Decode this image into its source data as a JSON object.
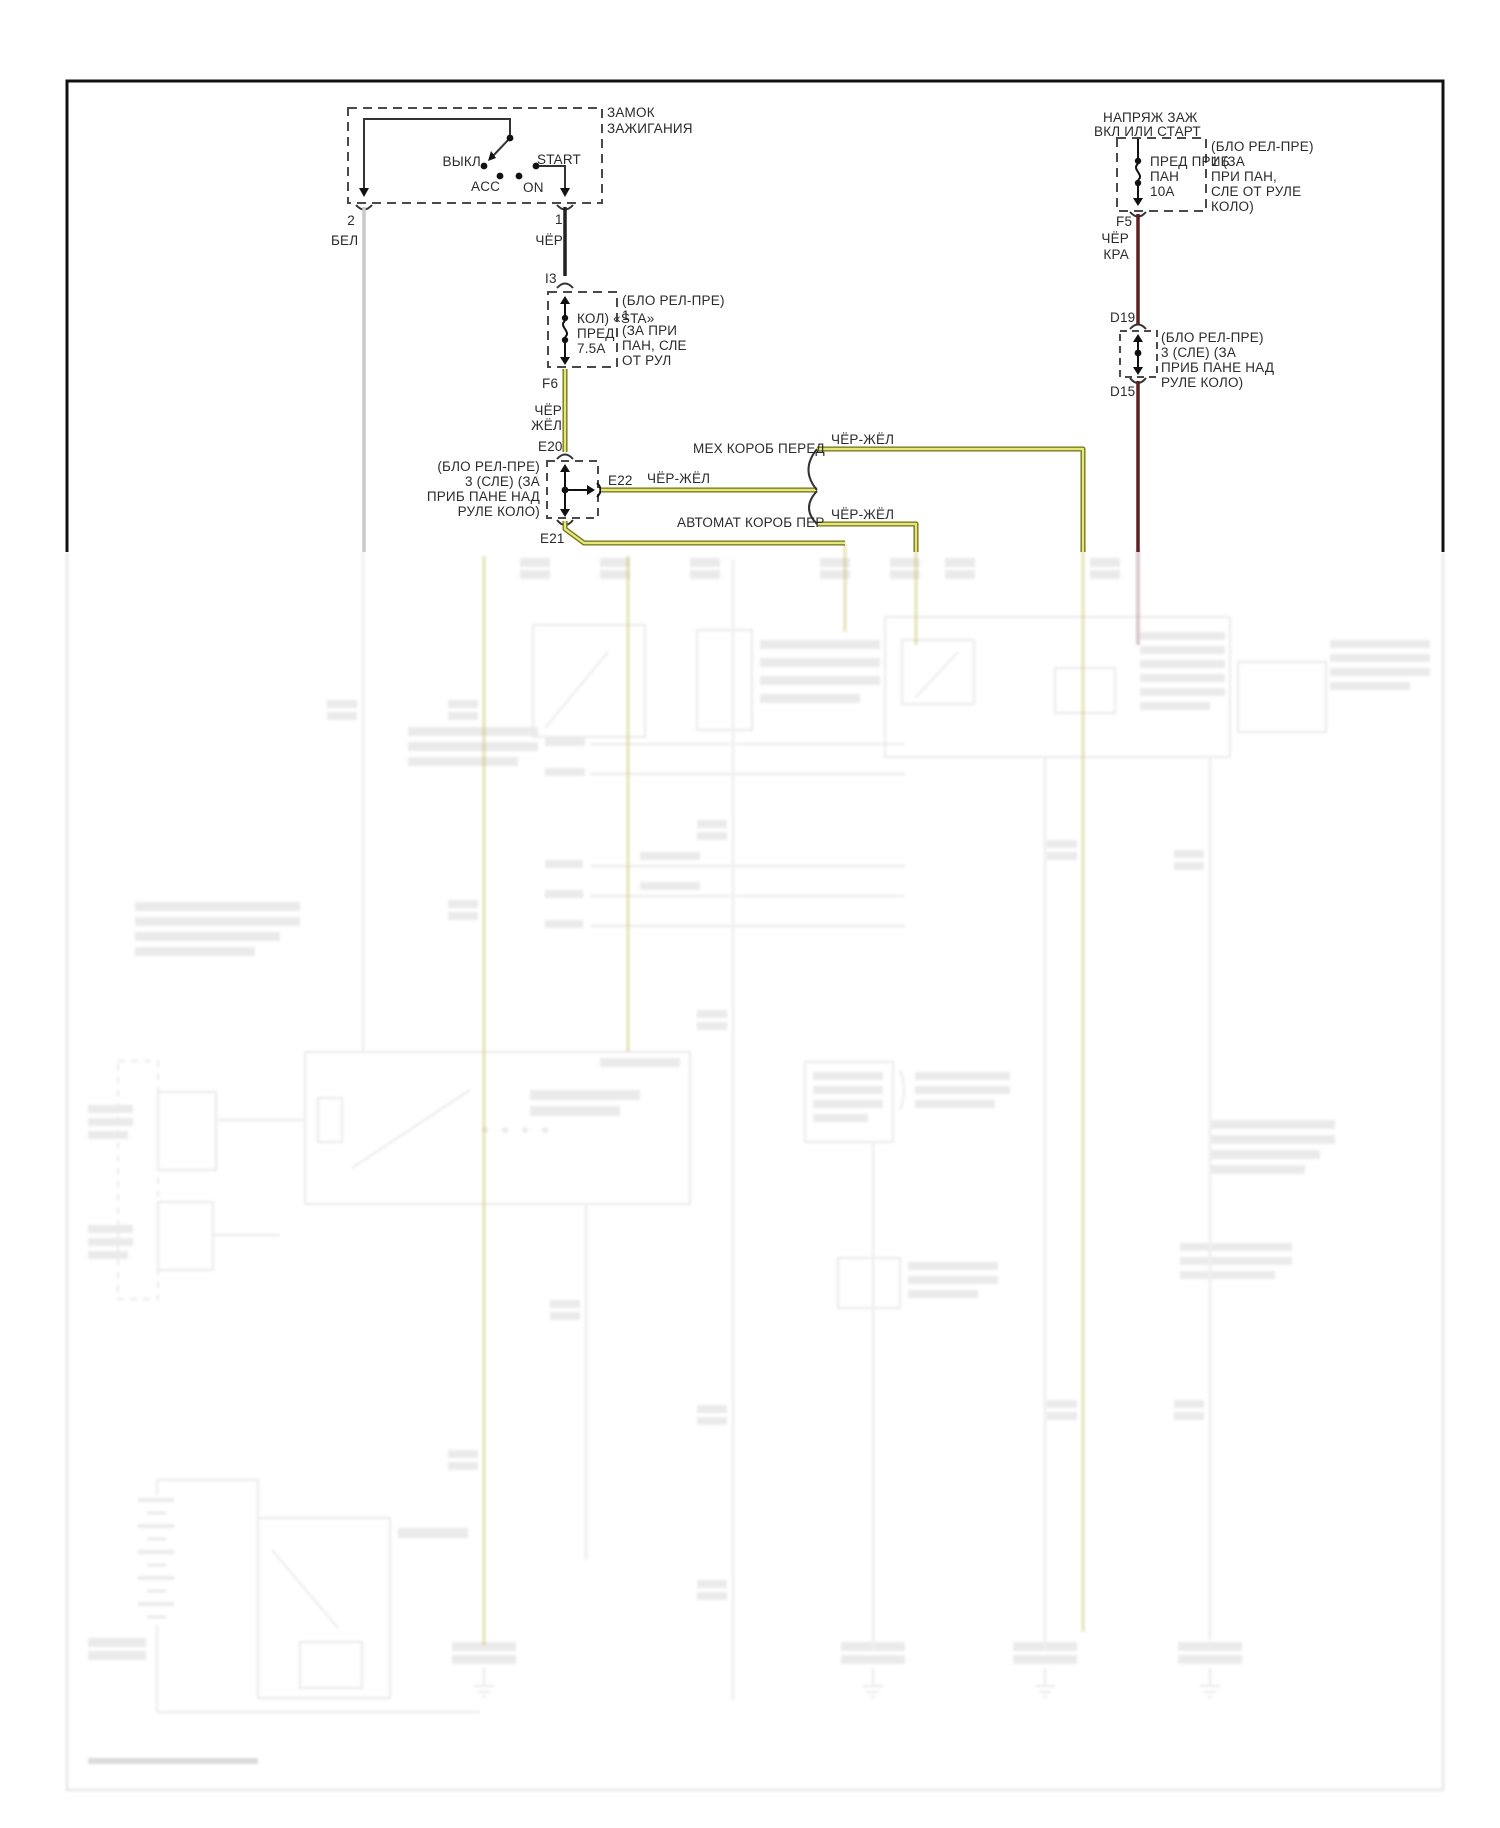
{
  "ignition_switch": {
    "title_line1": "ЗАМОК",
    "title_line2": "ЗАЖИГАНИЯ",
    "positions": {
      "off": "ВЫКЛ",
      "acc": "ACC",
      "on": "ON",
      "start": "START"
    },
    "pin_2": "2",
    "pin_1": "1"
  },
  "connectors": {
    "i3": "I3",
    "f6": "F6",
    "e20": "E20",
    "e21": "E21",
    "e22": "E22",
    "f5": "F5",
    "d19": "D19",
    "d15": "D15"
  },
  "wires": {
    "bel": "БЕЛ",
    "cher": "ЧЁР",
    "cher_zhel_line1": "ЧЁР",
    "cher_zhel_line2": "ЖЁЛ",
    "e22_label": "ЧЁР-ЖЁЛ",
    "manual_branch_label": "ЧЁР-ЖЁЛ",
    "auto_branch_label": "ЧЁР-ЖЁЛ",
    "cher_kra_line1": "ЧЁР",
    "cher_kra_line2": "КРА"
  },
  "fuse_sta": {
    "line1": "КОЛ) «STA»",
    "line2": "ПРЕД",
    "line3": "7.5А",
    "note": [
      "(БЛО РЕЛ-ПРЕ)",
      "1",
      "(ЗА ПРИ",
      "ПАН, СЛЕ",
      "ОТ РУЛ"
    ]
  },
  "fuse_instrument": {
    "line1": "ПРЕД ПРИБ",
    "line2": "ПАН",
    "line3": "10А",
    "note": [
      "(БЛО РЕЛ-ПРЕ)",
      "1 (ЗА",
      "ПРИ ПАН,",
      "СЛЕ ОТ РУЛЕ",
      "КОЛО)"
    ]
  },
  "junction_e20_note": [
    "(БЛО РЕЛ-ПРЕ)",
    "3 (СЛЕ) (ЗА",
    "ПРИБ ПАНЕ НАД",
    "РУЛЕ КОЛО)"
  ],
  "junction_d19_note": [
    "(БЛО РЕЛ-ПРЕ)",
    "3 (СЛЕ) (ЗА",
    "ПРИБ ПАНЕ НАД",
    "РУЛЕ КОЛО)"
  ],
  "right_feed": {
    "header_line1": "НАПРЯЖ ЗАЖ",
    "header_line2": "ВКЛ ИЛИ СТАРТ"
  },
  "branches": {
    "manual": "МЕХ КОРОБ ПЕРЕД",
    "auto": "АВТОМАТ КОРОБ ПЕР"
  },
  "colors": {
    "wire_white": "#c9c9c9",
    "wire_black": "#222222",
    "wire_black_yellow_fill": "#e6e67e",
    "wire_black_yellow_edge": "#6f6f12",
    "wire_black_red": "#5e2222",
    "line_dark": "#333333",
    "ghost": "#7a7a7a"
  }
}
